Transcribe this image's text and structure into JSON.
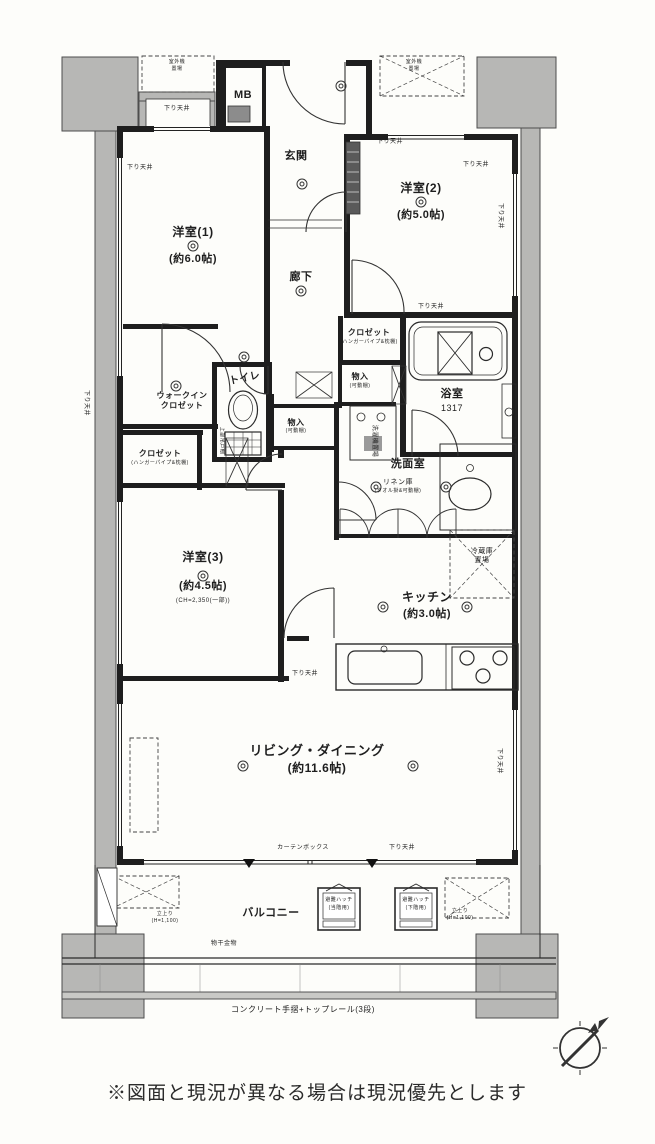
{
  "caption": "※図面と現況が異なる場合は現況優先とします",
  "plan": {
    "labels": [
      {
        "id": "room-yoshitsu1-name",
        "text": "洋室(1)",
        "x": 193,
        "y": 226,
        "fs": 12,
        "b": 1
      },
      {
        "id": "room-yoshitsu1-size",
        "text": "(約6.0帖)",
        "x": 193,
        "y": 254,
        "fs": 11,
        "b": 1
      },
      {
        "id": "room-yoshitsu2-name",
        "text": "洋室(2)",
        "x": 421,
        "y": 182,
        "fs": 12,
        "b": 1
      },
      {
        "id": "room-yoshitsu2-size",
        "text": "(約5.0帖)",
        "x": 421,
        "y": 210,
        "fs": 11,
        "b": 1
      },
      {
        "id": "room-yoshitsu3-name",
        "text": "洋室(3)",
        "x": 203,
        "y": 551,
        "fs": 12,
        "b": 1
      },
      {
        "id": "room-yoshitsu3-size",
        "text": "(約4.5帖)",
        "x": 203,
        "y": 581,
        "fs": 11,
        "b": 1
      },
      {
        "id": "room-yoshitsu3-ceiling",
        "text": "(CH=2,350(一部))",
        "x": 203,
        "y": 598,
        "fs": 6
      },
      {
        "id": "room-living-dining-name",
        "text": "リビング・ダイニング",
        "x": 317,
        "y": 744,
        "fs": 13,
        "b": 1
      },
      {
        "id": "room-living-dining-size",
        "text": "(約11.6帖)",
        "x": 317,
        "y": 762,
        "fs": 12,
        "b": 1
      },
      {
        "id": "room-kitchen-name",
        "text": "キッチン",
        "x": 427,
        "y": 591,
        "fs": 12,
        "b": 1
      },
      {
        "id": "room-kitchen-size",
        "text": "(約3.0帖)",
        "x": 427,
        "y": 609,
        "fs": 11,
        "b": 1
      },
      {
        "id": "room-genkan",
        "text": "玄関",
        "x": 296,
        "y": 151,
        "fs": 11,
        "b": 1
      },
      {
        "id": "room-rouka",
        "text": "廊下",
        "x": 301,
        "y": 272,
        "fs": 11,
        "b": 1
      },
      {
        "id": "meter-box",
        "text": "MB",
        "x": 243,
        "y": 90,
        "fs": 11,
        "b": 1
      },
      {
        "id": "room-toilet",
        "text": "トイレ",
        "x": 245,
        "y": 374,
        "fs": 10,
        "b": 1,
        "rot": -12
      },
      {
        "id": "walkin-closet-line1",
        "text": "ウォークイン",
        "x": 182,
        "y": 392,
        "fs": 8,
        "b": 1
      },
      {
        "id": "walkin-closet-line2",
        "text": "クロゼット",
        "x": 182,
        "y": 402,
        "fs": 8,
        "b": 1
      },
      {
        "id": "closet-left",
        "text": "クロゼット",
        "x": 160,
        "y": 450,
        "fs": 8,
        "b": 1
      },
      {
        "id": "closet-left-sub",
        "text": "(ハンガーパイプ&枕棚)",
        "x": 160,
        "y": 461,
        "fs": 5
      },
      {
        "id": "closet-center",
        "text": "クロゼット",
        "x": 369,
        "y": 329,
        "fs": 8,
        "b": 1
      },
      {
        "id": "closet-center-sub",
        "text": "(ハンガーパイプ&枕棚)",
        "x": 369,
        "y": 340,
        "fs": 5
      },
      {
        "id": "room-bath",
        "text": "浴室",
        "x": 452,
        "y": 389,
        "fs": 11,
        "b": 1
      },
      {
        "id": "bath-size",
        "text": "1317",
        "x": 452,
        "y": 404,
        "fs": 9
      },
      {
        "id": "room-senmen",
        "text": "洗面室",
        "x": 408,
        "y": 459,
        "fs": 11,
        "b": 1
      },
      {
        "id": "linen-closet",
        "text": "リネン庫",
        "x": 398,
        "y": 479,
        "fs": 7
      },
      {
        "id": "linen-closet-sub",
        "text": "(タオル掛&可動棚)",
        "x": 398,
        "y": 489,
        "fs": 5
      },
      {
        "id": "storage-a",
        "text": "物入",
        "x": 360,
        "y": 373,
        "fs": 8,
        "b": 1
      },
      {
        "id": "storage-a-sub",
        "text": "(可動棚)",
        "x": 360,
        "y": 384,
        "fs": 5
      },
      {
        "id": "washer-space",
        "text": "洗濯機置場",
        "x": 374,
        "y": 438,
        "fs": 6,
        "rot": 90
      },
      {
        "id": "storage-b",
        "text": "物入",
        "x": 296,
        "y": 419,
        "fs": 8,
        "b": 1
      },
      {
        "id": "storage-b-sub",
        "text": "(可動棚)",
        "x": 296,
        "y": 429,
        "fs": 5
      },
      {
        "id": "fridge-space-line1",
        "text": "冷蔵庫",
        "x": 482,
        "y": 548,
        "fs": 7
      },
      {
        "id": "fridge-space-line2",
        "text": "置場",
        "x": 482,
        "y": 557,
        "fs": 7
      },
      {
        "id": "room-balcony",
        "text": "バルコニー",
        "x": 271,
        "y": 908,
        "fs": 11,
        "b": 1
      },
      {
        "id": "hatch-left-line1",
        "text": "避難ハッチ",
        "x": 339,
        "y": 898,
        "fs": 5
      },
      {
        "id": "hatch-left-line2",
        "text": "(当階用)",
        "x": 339,
        "y": 906,
        "fs": 5
      },
      {
        "id": "hatch-right-line1",
        "text": "避難ハッチ",
        "x": 416,
        "y": 898,
        "fs": 5
      },
      {
        "id": "hatch-right-line2",
        "text": "(下階用)",
        "x": 416,
        "y": 906,
        "fs": 5
      },
      {
        "id": "laundry-hardware",
        "text": "物干金物",
        "x": 224,
        "y": 941,
        "fs": 6
      },
      {
        "id": "handrail-note",
        "text": "コンクリート手摺+トップレール(3段)",
        "x": 303,
        "y": 1006,
        "fs": 8
      },
      {
        "id": "dropped-ceiling-1",
        "text": "下り天井",
        "x": 140,
        "y": 165,
        "fs": 6
      },
      {
        "id": "dropped-ceiling-2",
        "text": "下り天井",
        "x": 177,
        "y": 106,
        "fs": 6
      },
      {
        "id": "dropped-ceiling-3",
        "text": "下り天井",
        "x": 390,
        "y": 139,
        "fs": 6
      },
      {
        "id": "dropped-ceiling-4",
        "text": "下り天井",
        "x": 476,
        "y": 162,
        "fs": 6
      },
      {
        "id": "dropped-ceiling-5",
        "text": "下り天井",
        "x": 431,
        "y": 304,
        "fs": 6
      },
      {
        "id": "dropped-ceiling-6",
        "text": "下り天井",
        "x": 305,
        "y": 671,
        "fs": 6
      },
      {
        "id": "dropped-ceiling-7",
        "text": "下り天井",
        "x": 402,
        "y": 845,
        "fs": 6
      },
      {
        "id": "dropped-ceiling-8",
        "text": "下り天井",
        "x": 86,
        "y": 400,
        "fs": 6,
        "rot": 90
      },
      {
        "id": "dropped-ceiling-9",
        "text": "下り天井",
        "x": 500,
        "y": 213,
        "fs": 6,
        "rot": 90
      },
      {
        "id": "dropped-ceiling-10",
        "text": "下り天井",
        "x": 499,
        "y": 758,
        "fs": 6,
        "rot": 90
      },
      {
        "id": "curtain-box",
        "text": "カーテンボックス",
        "x": 303,
        "y": 845,
        "fs": 6
      },
      {
        "id": "parapet-left-line1",
        "text": "立上り",
        "x": 165,
        "y": 912,
        "fs": 5
      },
      {
        "id": "parapet-left-line2",
        "text": "(H=1,100)",
        "x": 165,
        "y": 919,
        "fs": 5
      },
      {
        "id": "parapet-right-line1",
        "text": "立上り",
        "x": 460,
        "y": 909,
        "fs": 5
      },
      {
        "id": "parapet-right-line2",
        "text": "(H=1,100)",
        "x": 460,
        "y": 916,
        "fs": 5
      },
      {
        "id": "upper-cabinet",
        "text": "上部吊戸棚",
        "x": 221,
        "y": 438,
        "fs": 5,
        "rot": 90
      },
      {
        "id": "outdoor-unit-left-line1",
        "text": "室外機",
        "x": 177,
        "y": 60,
        "fs": 5
      },
      {
        "id": "outdoor-unit-left-line2",
        "text": "置場",
        "x": 177,
        "y": 67,
        "fs": 5
      },
      {
        "id": "outdoor-unit-right-line1",
        "text": "室外機",
        "x": 414,
        "y": 60,
        "fs": 5
      },
      {
        "id": "outdoor-unit-right-line2",
        "text": "置場",
        "x": 414,
        "y": 67,
        "fs": 5
      }
    ]
  }
}
